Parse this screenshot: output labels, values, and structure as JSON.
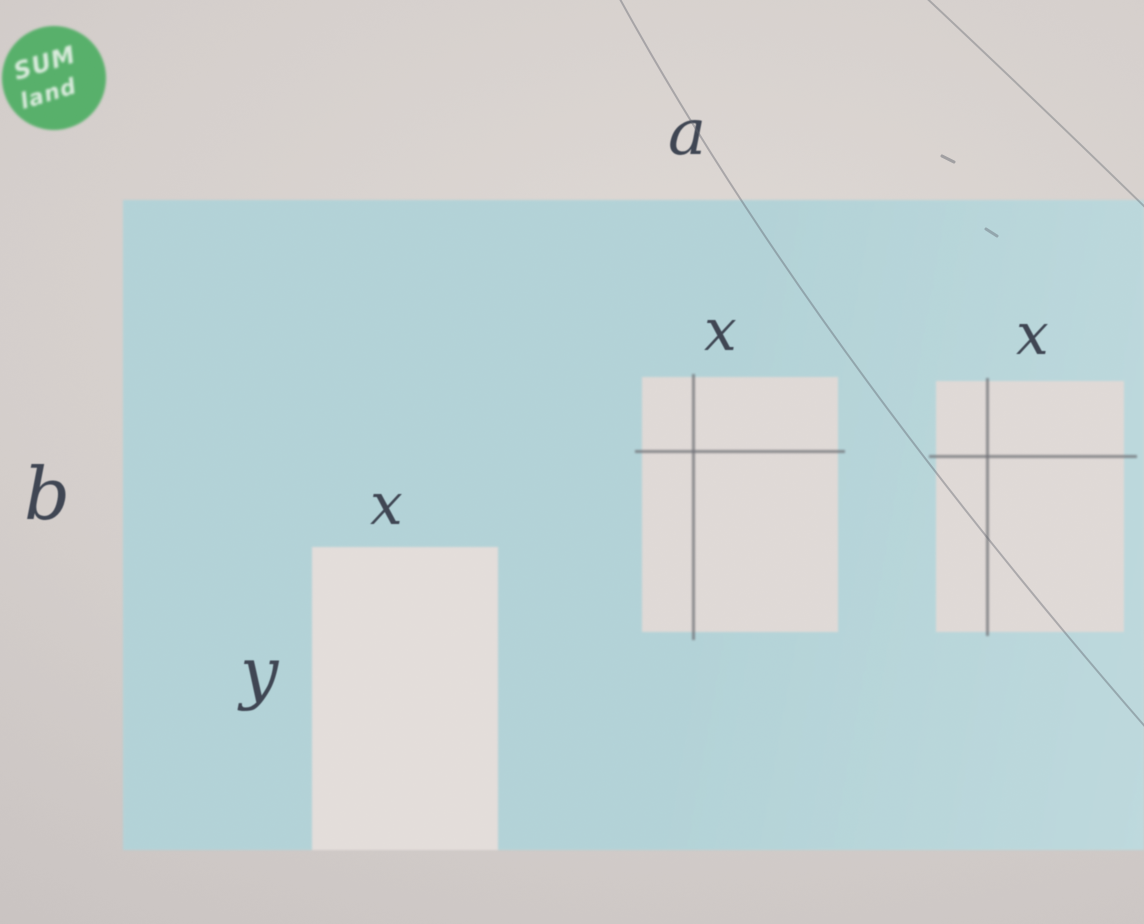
{
  "figure": {
    "type": "geometry-diagram",
    "description_labels": {
      "wall_width": "a",
      "wall_height": "b",
      "door_width": "x",
      "door_height": "y",
      "window1_width": "x",
      "window2_width": "x"
    },
    "colors": {
      "background": "#d5cfcc",
      "wall_blue": "#b3d3d8",
      "cutout_white": "#e4dedb",
      "window_white": "#e0dad7",
      "label_ink": "#3e4552",
      "pane_line": "#6f7076",
      "pencil_line": "#5c6068",
      "logo_green": "#57b06a",
      "logo_text": "#f2f7f2"
    },
    "logo": {
      "line1": "SUM",
      "line2": "land"
    }
  }
}
